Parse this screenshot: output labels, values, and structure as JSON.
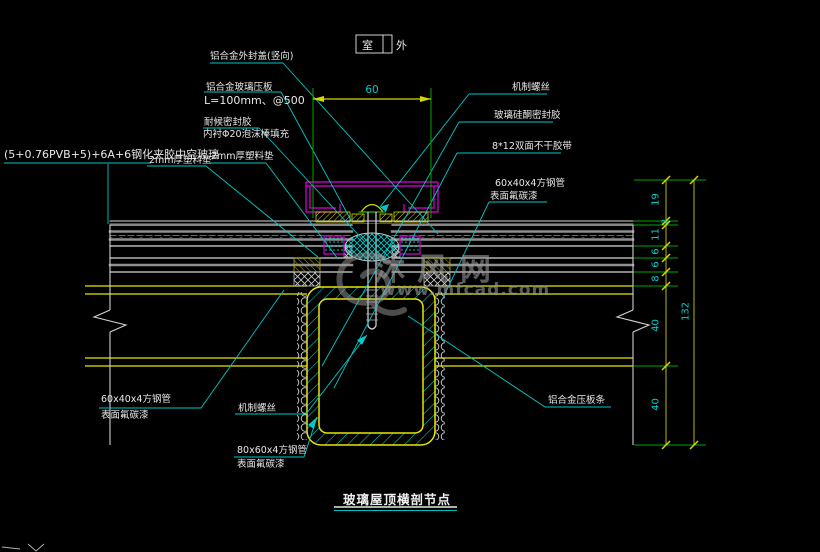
{
  "drawing": {
    "title": "玻璃屋顶横剖节点",
    "room_box": {
      "inside": "室",
      "outside": "外"
    },
    "watermark": {
      "site_name": "沐风网",
      "site_url": "www.mfcad.com"
    }
  },
  "dimensions": {
    "top_width": "60",
    "right_chain": [
      "19",
      "2",
      "11",
      "6",
      "6",
      "8",
      "40",
      "40"
    ],
    "right_total": "132"
  },
  "labels": {
    "cap": "铝合金外封盖(竖向)",
    "press_plate_line1": "铝合金玻璃压板",
    "press_plate_line2": "L=100mm、@500",
    "sealant_line1": "耐候密封胶",
    "sealant_line2": "内衬Φ20泡沫棒填充",
    "glass": "(5+0.76PVB+5)+6A+6钢化夹胶中空玻璃",
    "pad_left": "2mm厚塑料垫",
    "pad_right": "2mm厚塑料垫",
    "screw_top": "机制螺丝",
    "silicone_sealant": "玻璃硅酮密封胶",
    "tape": "8*12双面不干胶带",
    "tube60_right_line1": "60x40x4方钢管",
    "tube60_right_line2": "表面氟碳漆",
    "tube60_left_line1": "60x40x4方钢管",
    "tube60_left_line2": "表面氟碳漆",
    "screw_bottom": "机制螺丝",
    "tube80_line1": "80x60x4方钢管",
    "tube80_line2": "表面氟碳漆",
    "alu_strip": "铝合金压板条"
  },
  "colors": {
    "background": "#000000",
    "leader_cyan": "#00c8c8",
    "dimension_green": "#00a800",
    "dimension_yellow": "#d8d800",
    "dim_text_cyan": "#00cccc",
    "label_text": "#e8e8e8",
    "glass_line": "#c8c8c8",
    "steel_yellow": "#e8e800",
    "cap_magenta": "#e000e0",
    "hatch_cyan": "#00d0d0",
    "watermark_gray": "#9a9a9a"
  }
}
